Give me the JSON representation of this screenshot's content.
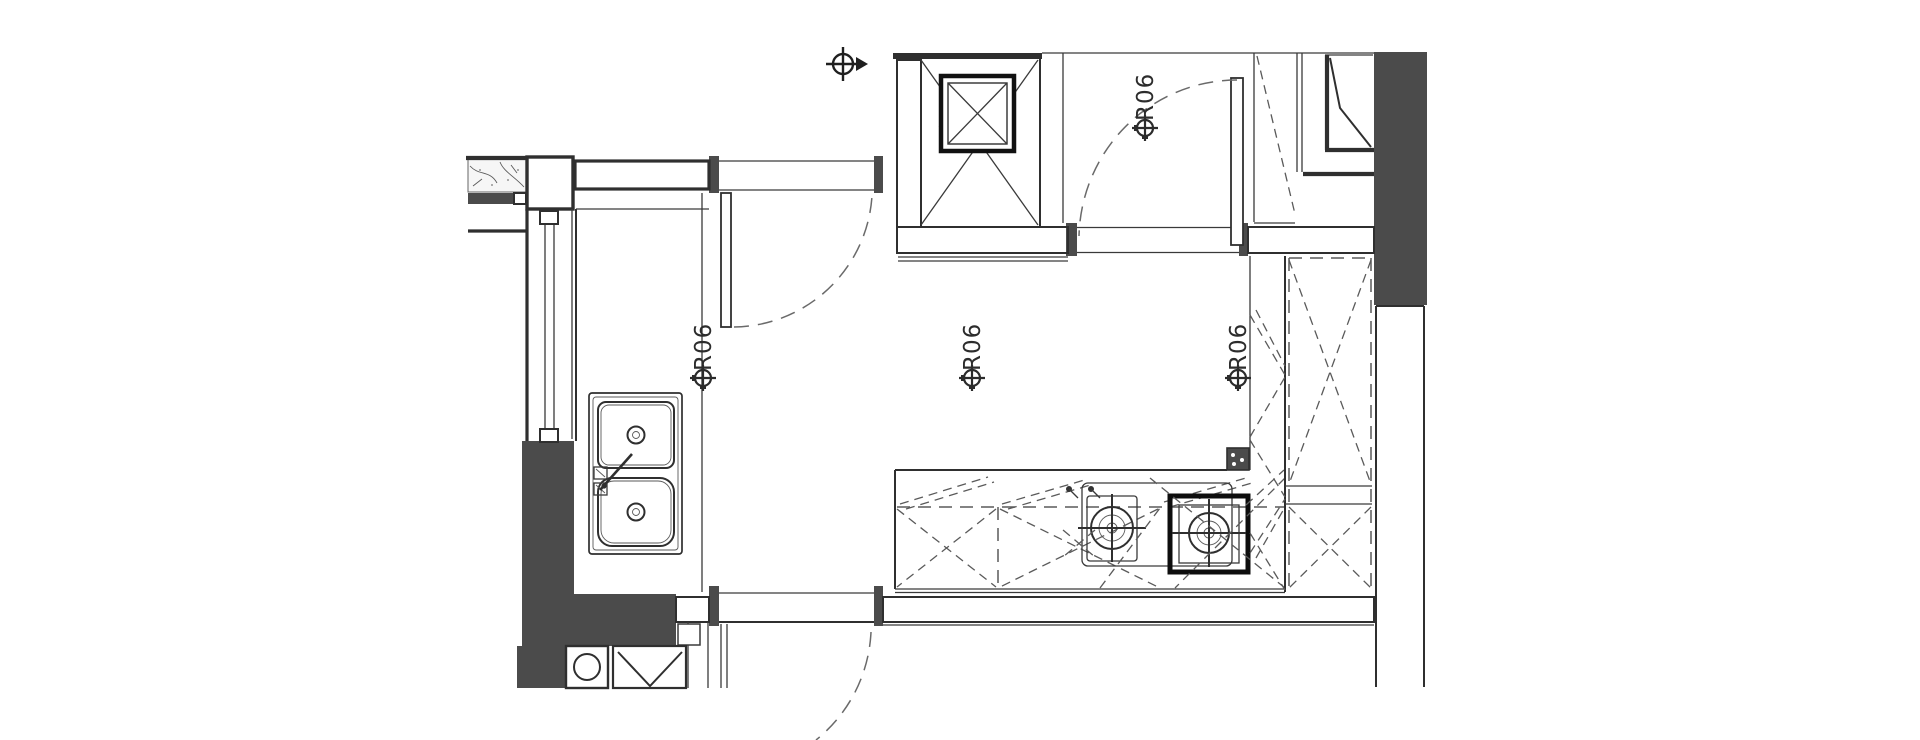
{
  "drawing": {
    "title": "kitchen-floor-plan",
    "labels": {
      "room_marker_left": "R06",
      "room_marker_center": "R06",
      "room_marker_right": "R06",
      "door_marker_top": "R06"
    },
    "colors": {
      "background": "#ffffff",
      "line": "#2f2f2f",
      "wall_fill": "#4b4b4b",
      "hatch_background": "#3b3b3b",
      "hatch_dot": "#ffffff",
      "dashed_line": "#5a5a5a",
      "label_text": "#2c2c2c"
    },
    "symbols": [
      "position-marker-icon",
      "survey-point-arrow-icon",
      "double-bowl-sink",
      "sink-faucet",
      "gas-hob-burner",
      "highlighted-burner-frame",
      "duct-shaft-cross",
      "door-swing-arc",
      "door-leaf",
      "window-section",
      "washing-machine",
      "base-cabinet-dashed",
      "tall-cabinet-dashed",
      "insulated-wall-hatch",
      "stone-wall-texture"
    ]
  }
}
